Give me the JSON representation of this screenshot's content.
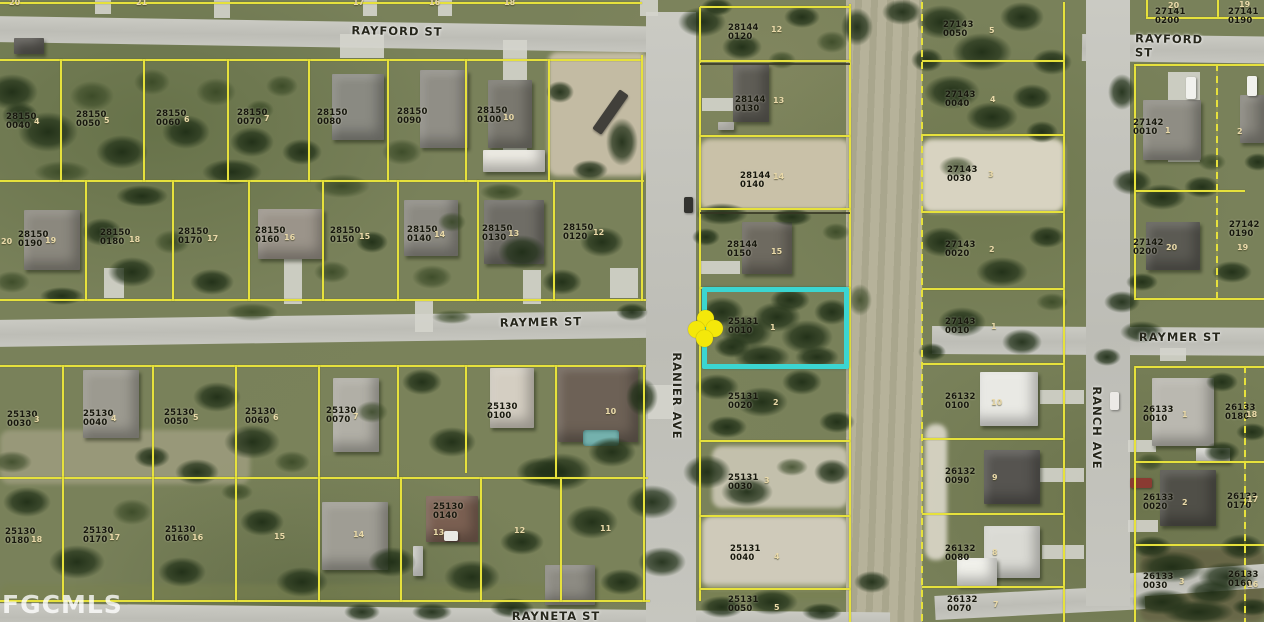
{
  "watermark": "FGCMLS",
  "map": {
    "width": 1264,
    "height": 622
  },
  "highlight": {
    "parcel": "25131 0010",
    "x": 702,
    "y": 287,
    "w": 147,
    "h": 82,
    "color": "#3bd5d1"
  },
  "marker": {
    "name": "subject-property",
    "x": 705,
    "y": 328,
    "color": "#f4e80a"
  },
  "colors": {
    "parcel_line": "#e6e13c",
    "label_text": "#17170d",
    "lot_text": "#e9d9a9",
    "road": "#c6c6bf",
    "highlight": "#3bd5d1"
  },
  "streets": [
    {
      "name": "RAYFORD ST",
      "x": 397,
      "y": 31,
      "rot": 1
    },
    {
      "name": "RAYFORD ST",
      "x": 1178,
      "y": 46,
      "rot": 1
    },
    {
      "name": "RAYMER ST",
      "x": 541,
      "y": 322,
      "rot": -1
    },
    {
      "name": "RAYMER ST",
      "x": 1180,
      "y": 337,
      "rot": 0
    },
    {
      "name": "RAYNETA ST",
      "x": 556,
      "y": 616,
      "rot": 0
    },
    {
      "name": "RANIER AVE",
      "x": 677,
      "y": 396,
      "rot": 90
    },
    {
      "name": "RANCH AVE",
      "x": 1097,
      "y": 428,
      "rot": 90
    }
  ],
  "parcels": [
    {
      "label": "28150\n0040",
      "x": 6,
      "y": 113
    },
    {
      "label": "28150\n0050",
      "x": 76,
      "y": 111
    },
    {
      "label": "28150\n0060",
      "x": 156,
      "y": 110
    },
    {
      "label": "28150\n0070",
      "x": 237,
      "y": 109
    },
    {
      "label": "28150\n0080",
      "x": 317,
      "y": 109
    },
    {
      "label": "28150\n0090",
      "x": 397,
      "y": 108
    },
    {
      "label": "28150\n0100",
      "x": 477,
      "y": 107
    },
    {
      "label": "28150\n0190",
      "x": 18,
      "y": 231
    },
    {
      "label": "28150\n0180",
      "x": 100,
      "y": 229
    },
    {
      "label": "28150\n0170",
      "x": 178,
      "y": 228
    },
    {
      "label": "28150\n0160",
      "x": 255,
      "y": 227
    },
    {
      "label": "28150\n0150",
      "x": 330,
      "y": 227
    },
    {
      "label": "28150\n0140",
      "x": 407,
      "y": 226
    },
    {
      "label": "28150\n0130",
      "x": 482,
      "y": 225
    },
    {
      "label": "28150\n0120",
      "x": 563,
      "y": 224
    },
    {
      "label": "25130\n0030",
      "x": 7,
      "y": 411
    },
    {
      "label": "25130\n0040",
      "x": 83,
      "y": 410
    },
    {
      "label": "25130\n0050",
      "x": 164,
      "y": 409
    },
    {
      "label": "25130\n0060",
      "x": 245,
      "y": 408
    },
    {
      "label": "25130\n0070",
      "x": 326,
      "y": 407
    },
    {
      "label": "25130\n0100",
      "x": 487,
      "y": 403
    },
    {
      "label": "25130\n0180",
      "x": 5,
      "y": 528
    },
    {
      "label": "25130\n0170",
      "x": 83,
      "y": 527
    },
    {
      "label": "25130\n0160",
      "x": 165,
      "y": 526
    },
    {
      "label": "25130\n0140",
      "x": 433,
      "y": 503
    },
    {
      "label": "28144\n0120",
      "x": 728,
      "y": 24
    },
    {
      "label": "28144\n0130",
      "x": 735,
      "y": 96
    },
    {
      "label": "28144\n0140",
      "x": 740,
      "y": 172
    },
    {
      "label": "28144\n0150",
      "x": 727,
      "y": 241
    },
    {
      "label": "25131\n0010",
      "x": 728,
      "y": 318
    },
    {
      "label": "25131\n0020",
      "x": 728,
      "y": 393
    },
    {
      "label": "25131\n0030",
      "x": 728,
      "y": 474
    },
    {
      "label": "25131\n0040",
      "x": 730,
      "y": 545
    },
    {
      "label": "25131\n0050",
      "x": 728,
      "y": 596
    },
    {
      "label": "27143\n0050",
      "x": 943,
      "y": 21
    },
    {
      "label": "27143\n0040",
      "x": 945,
      "y": 91
    },
    {
      "label": "27143\n0030",
      "x": 947,
      "y": 166
    },
    {
      "label": "27143\n0020",
      "x": 945,
      "y": 241
    },
    {
      "label": "27143\n0010",
      "x": 945,
      "y": 318
    },
    {
      "label": "26132\n0100",
      "x": 945,
      "y": 393
    },
    {
      "label": "26132\n0090",
      "x": 945,
      "y": 468
    },
    {
      "label": "26132\n0080",
      "x": 945,
      "y": 545
    },
    {
      "label": "26132\n0070",
      "x": 947,
      "y": 596
    },
    {
      "label": "27141\n0200",
      "x": 1155,
      "y": 8
    },
    {
      "label": "27141\n0190",
      "x": 1228,
      "y": 8
    },
    {
      "label": "27142\n0010",
      "x": 1133,
      "y": 119
    },
    {
      "label": "27142\n0200",
      "x": 1133,
      "y": 239
    },
    {
      "label": "27142\n0190",
      "x": 1229,
      "y": 221
    },
    {
      "label": "26133\n0010",
      "x": 1143,
      "y": 406
    },
    {
      "label": "26133\n0180",
      "x": 1225,
      "y": 404
    },
    {
      "label": "26133\n0020",
      "x": 1143,
      "y": 494
    },
    {
      "label": "26133\n0170",
      "x": 1227,
      "y": 493
    },
    {
      "label": "26133\n0030",
      "x": 1143,
      "y": 573
    },
    {
      "label": "26133\n0160",
      "x": 1228,
      "y": 571
    }
  ],
  "lots": [
    {
      "n": "4",
      "x": 34,
      "y": 117
    },
    {
      "n": "5",
      "x": 104,
      "y": 116
    },
    {
      "n": "6",
      "x": 184,
      "y": 115
    },
    {
      "n": "7",
      "x": 264,
      "y": 114
    },
    {
      "n": "10",
      "x": 503,
      "y": 113
    },
    {
      "n": "20",
      "x": 1,
      "y": 237
    },
    {
      "n": "19",
      "x": 45,
      "y": 236
    },
    {
      "n": "18",
      "x": 129,
      "y": 235
    },
    {
      "n": "17",
      "x": 207,
      "y": 234
    },
    {
      "n": "16",
      "x": 284,
      "y": 233
    },
    {
      "n": "15",
      "x": 359,
      "y": 232
    },
    {
      "n": "14",
      "x": 434,
      "y": 230
    },
    {
      "n": "13",
      "x": 508,
      "y": 229
    },
    {
      "n": "12",
      "x": 593,
      "y": 228
    },
    {
      "n": "3",
      "x": 34,
      "y": 415
    },
    {
      "n": "4",
      "x": 111,
      "y": 414
    },
    {
      "n": "5",
      "x": 193,
      "y": 413
    },
    {
      "n": "6",
      "x": 273,
      "y": 413
    },
    {
      "n": "7",
      "x": 353,
      "y": 412
    },
    {
      "n": "10",
      "x": 605,
      "y": 407
    },
    {
      "n": "18",
      "x": 31,
      "y": 535
    },
    {
      "n": "17",
      "x": 109,
      "y": 533
    },
    {
      "n": "16",
      "x": 192,
      "y": 533
    },
    {
      "n": "15",
      "x": 274,
      "y": 532
    },
    {
      "n": "14",
      "x": 353,
      "y": 530
    },
    {
      "n": "13",
      "x": 433,
      "y": 528
    },
    {
      "n": "12",
      "x": 514,
      "y": 526
    },
    {
      "n": "11",
      "x": 600,
      "y": 524
    },
    {
      "n": "12",
      "x": 771,
      "y": 25
    },
    {
      "n": "13",
      "x": 773,
      "y": 96
    },
    {
      "n": "14",
      "x": 773,
      "y": 172
    },
    {
      "n": "15",
      "x": 771,
      "y": 247
    },
    {
      "n": "1",
      "x": 770,
      "y": 323
    },
    {
      "n": "2",
      "x": 773,
      "y": 398
    },
    {
      "n": "3",
      "x": 764,
      "y": 476
    },
    {
      "n": "4",
      "x": 774,
      "y": 552
    },
    {
      "n": "5",
      "x": 774,
      "y": 603
    },
    {
      "n": "5",
      "x": 989,
      "y": 26
    },
    {
      "n": "4",
      "x": 990,
      "y": 95
    },
    {
      "n": "3",
      "x": 988,
      "y": 170
    },
    {
      "n": "2",
      "x": 989,
      "y": 245
    },
    {
      "n": "1",
      "x": 991,
      "y": 322
    },
    {
      "n": "10",
      "x": 991,
      "y": 398
    },
    {
      "n": "9",
      "x": 992,
      "y": 473
    },
    {
      "n": "8",
      "x": 992,
      "y": 548
    },
    {
      "n": "7",
      "x": 993,
      "y": 600
    },
    {
      "n": "20",
      "x": 1168,
      "y": 1
    },
    {
      "n": "19",
      "x": 1239,
      "y": 0
    },
    {
      "n": "1",
      "x": 1165,
      "y": 126
    },
    {
      "n": "2",
      "x": 1237,
      "y": 127
    },
    {
      "n": "20",
      "x": 1166,
      "y": 243
    },
    {
      "n": "19",
      "x": 1237,
      "y": 243
    },
    {
      "n": "1",
      "x": 1182,
      "y": 410
    },
    {
      "n": "18",
      "x": 1246,
      "y": 410
    },
    {
      "n": "2",
      "x": 1182,
      "y": 498
    },
    {
      "n": "17",
      "x": 1247,
      "y": 495
    },
    {
      "n": "3",
      "x": 1179,
      "y": 577
    },
    {
      "n": "16",
      "x": 1247,
      "y": 580
    },
    {
      "n": "20",
      "x": 9,
      "y": -2
    },
    {
      "n": "21",
      "x": 136,
      "y": -2
    },
    {
      "n": "17",
      "x": 353,
      "y": -2
    },
    {
      "n": "16",
      "x": 429,
      "y": -2
    },
    {
      "n": "18",
      "x": 504,
      "y": -2
    }
  ]
}
